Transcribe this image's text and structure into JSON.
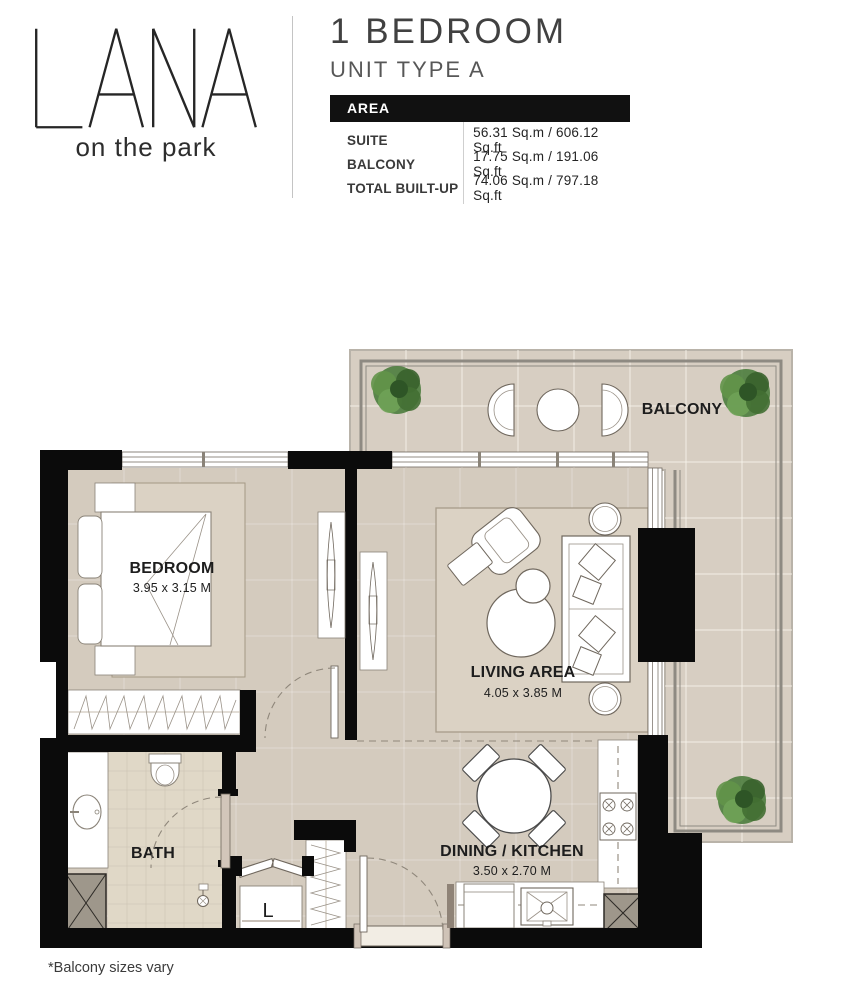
{
  "brand": {
    "name": "LANA",
    "tagline": "on the park"
  },
  "unit": {
    "title": "1 BEDROOM",
    "subtitle": "UNIT TYPE A"
  },
  "area_table": {
    "header": "AREA",
    "rows": [
      {
        "label": "SUITE",
        "value": "56.31 Sq.m / 606.12 Sq.ft"
      },
      {
        "label": "BALCONY",
        "value": "17.75 Sq.m / 191.06 Sq.ft"
      },
      {
        "label": "TOTAL BUILT-UP",
        "value": "74.06 Sq.m / 797.18 Sq.ft"
      }
    ]
  },
  "floor_plan": {
    "rooms": {
      "balcony": {
        "name": "BALCONY"
      },
      "bedroom": {
        "name": "BEDROOM",
        "dimensions": "3.95 x 3.15 M"
      },
      "living": {
        "name": "LIVING AREA",
        "dimensions": "4.05 x 3.85 M"
      },
      "dining": {
        "name": "DINING / KITCHEN",
        "dimensions": "3.50 x 2.70 M"
      },
      "bath": {
        "name": "BATH"
      },
      "laundry": {
        "name": "L"
      }
    },
    "colors": {
      "wall": "#0b0b0b",
      "floor": "#d4cbbe",
      "balconyFloor": "#d7cec2",
      "bathTile": "#e0d8c7",
      "rug": "#dbd2c4",
      "shaft": "#9e978b",
      "plant": "#497b3c",
      "tableHeaderBg": "#111111"
    }
  },
  "footnote": "*Balcony sizes vary"
}
